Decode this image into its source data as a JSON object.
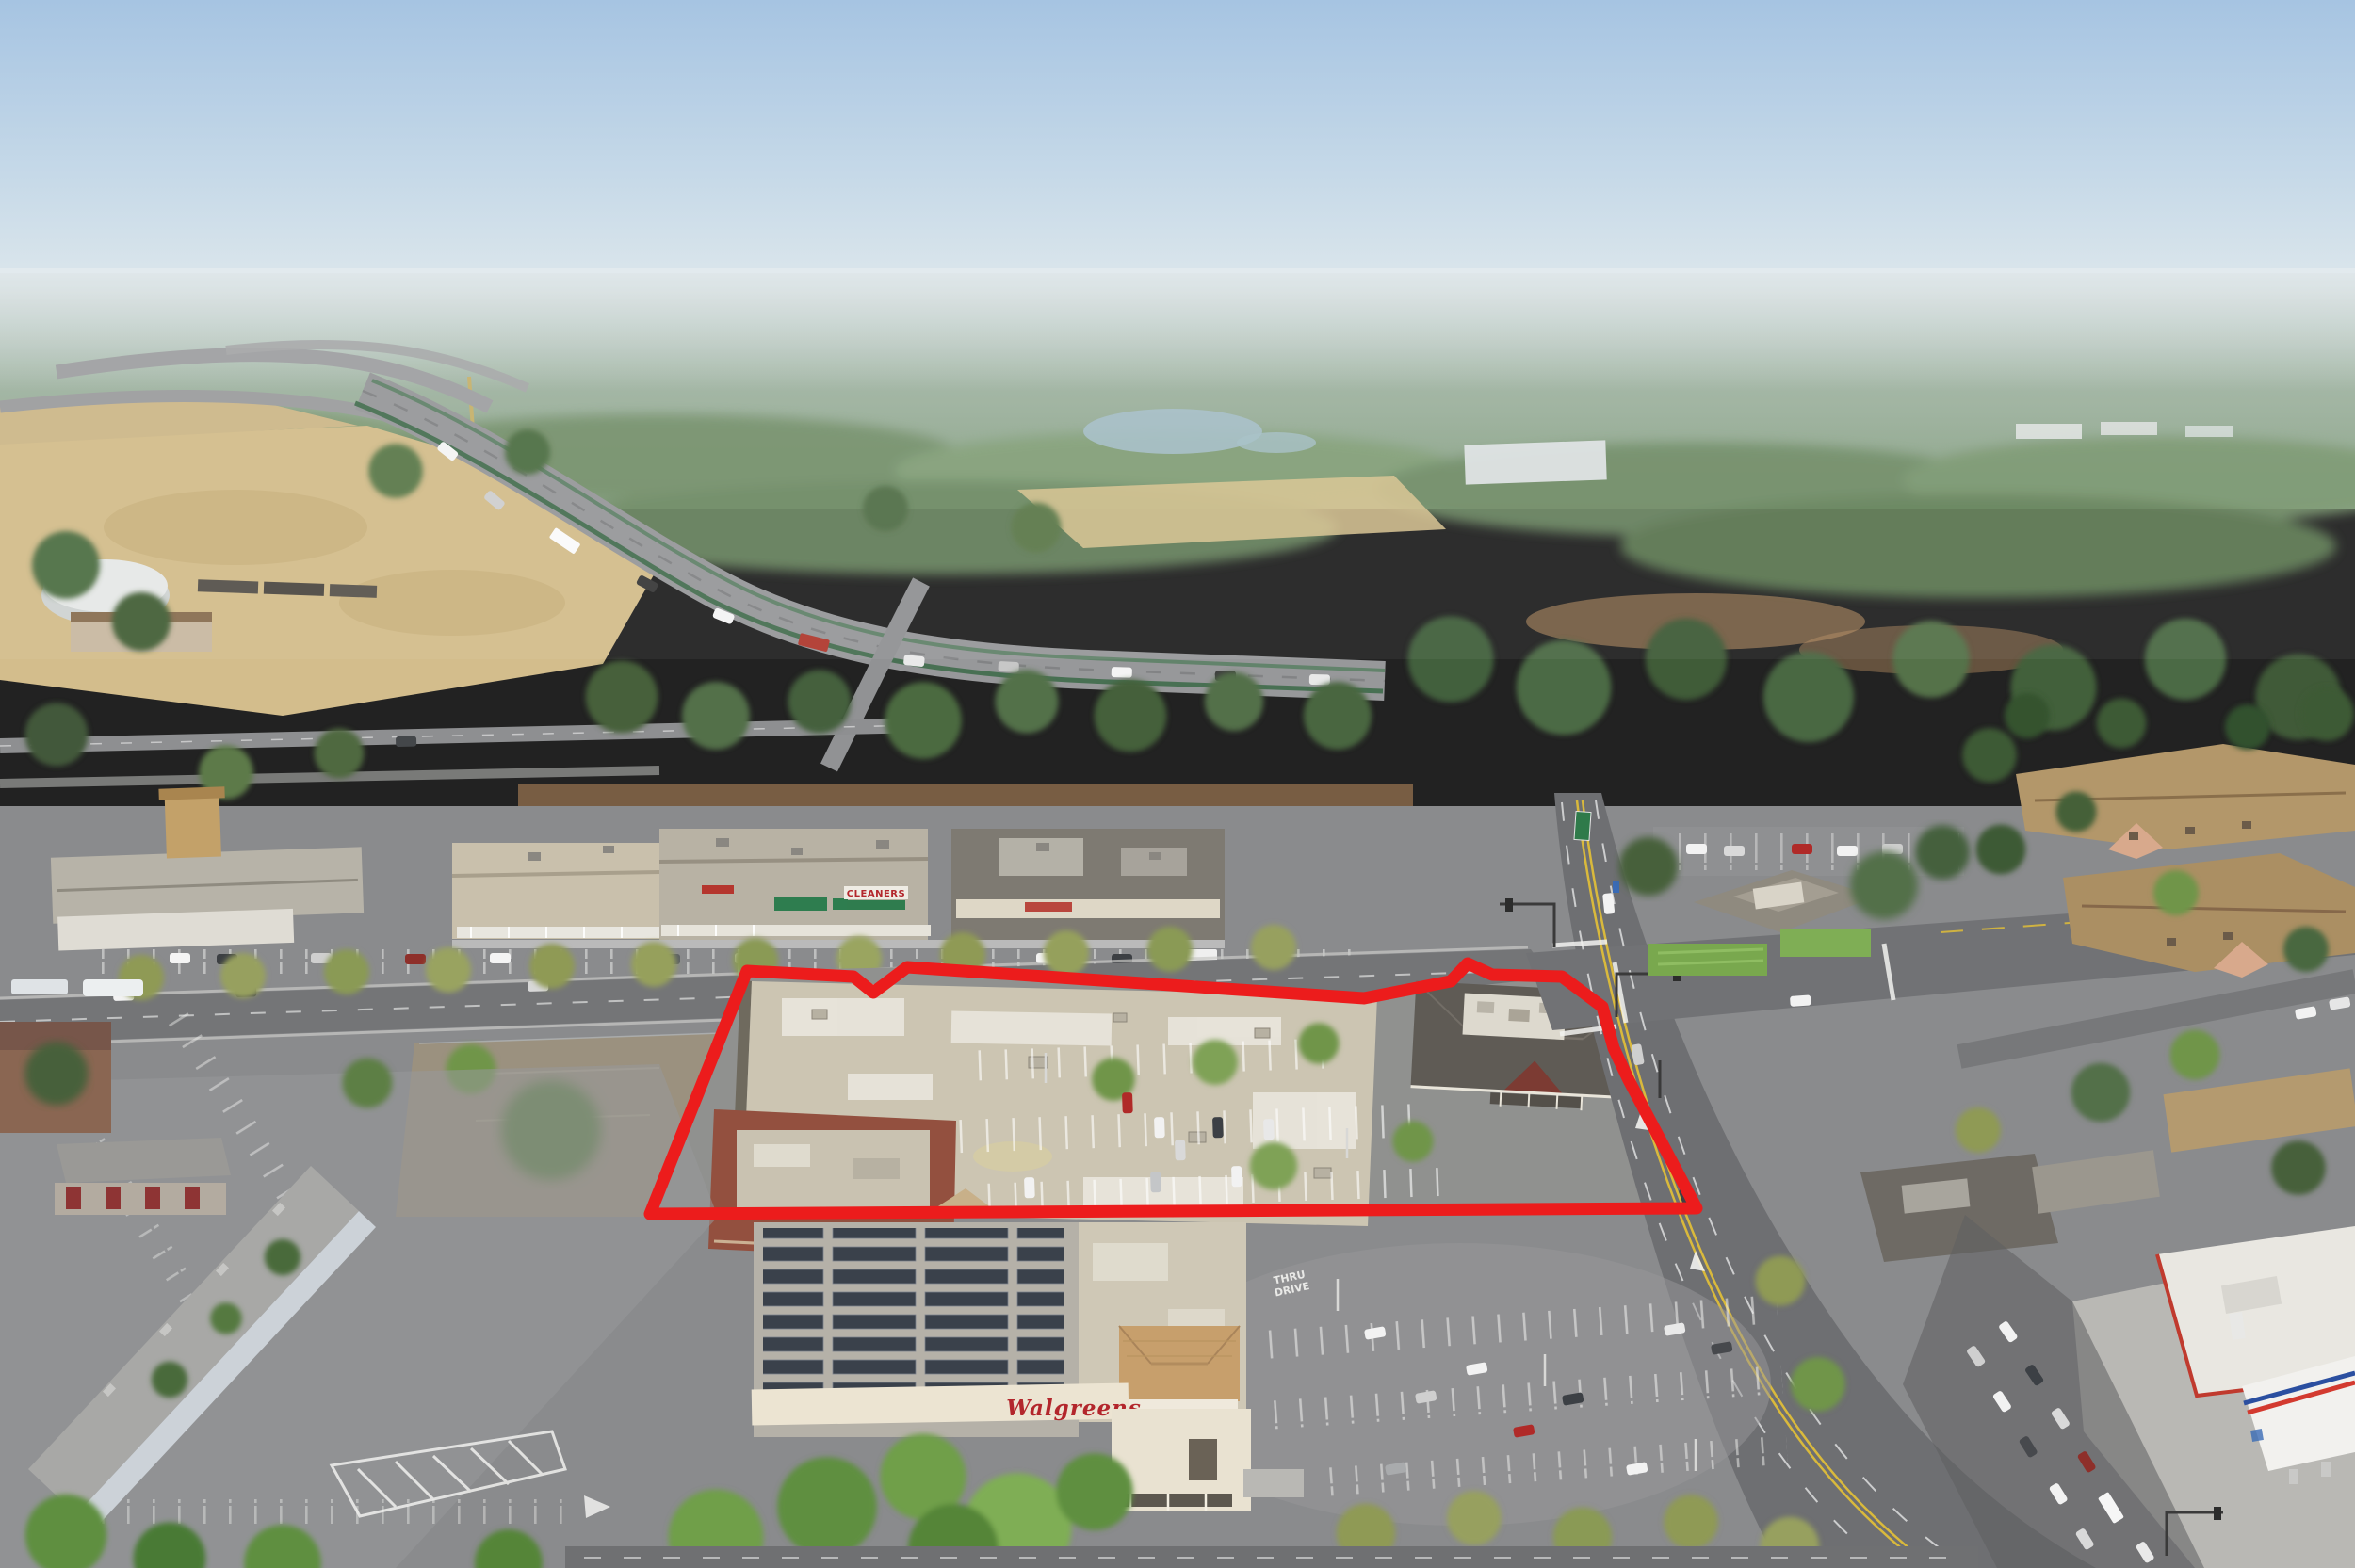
{
  "image": {
    "type": "aerial-drone-photograph",
    "description": "Oblique aerial photo of a suburban commercial corridor on a clear hazy day. A thick red boundary polygon highlights a subject property containing a large flat-roof retail building, a striped parking field with tree planters, and a corner pad building beside a signalized intersection. A Walgreens drugstore with rooftop solar panels sits in the foreground; a strip mall with a CLEANERS storefront sits behind the site; an elevated freeway interchange, dry fields, a water tank, a freight train and tree-covered suburbs fill the background.",
    "time_of_day": "morning, long shadows to upper-left",
    "horizon": "flat, hazy blue-white"
  },
  "annotation": {
    "name": "subject-property-outline",
    "shape": "polygon",
    "color": "#ec1c1c",
    "stroke_width_px": 13,
    "vertices": [
      [
        690,
        1289
      ],
      [
        793,
        1031
      ],
      [
        906,
        1037
      ],
      [
        927,
        1054
      ],
      [
        963,
        1027
      ],
      [
        1448,
        1060
      ],
      [
        1540,
        1042
      ],
      [
        1558,
        1023
      ],
      [
        1584,
        1035
      ],
      [
        1658,
        1037
      ],
      [
        1701,
        1069
      ],
      [
        1713,
        1113
      ],
      [
        1729,
        1147
      ],
      [
        1801,
        1283
      ]
    ],
    "encloses": [
      "flat-roof retail building with maroon storefront",
      "parking field with landscaped planters",
      "hip-roof corner pad building"
    ]
  },
  "signs": {
    "cleaners": "CLEANERS",
    "walgreens": "Walgreens",
    "pavement_line1": "THRU",
    "pavement_line2": "DRIVE"
  },
  "palette": {
    "annotation_red": "#ec1c1c",
    "sign_red": "#b3262c",
    "marking_white": "#e9e9e7",
    "sky_top": "#a6c4e2",
    "sky_horizon": "#dde7ec",
    "distant_trees": "#8aa383",
    "dry_grass": "#d3bd8c",
    "asphalt": "#8a8b8d",
    "asphalt_dark": "#6e6f72",
    "roof_light": "#ccc5b2",
    "roof_dark": "#5f5b55",
    "maroon_wall": "#93503f",
    "tree_dark": "#46603a",
    "tree_olive": "#8f9a55",
    "tree_green": "#6f9549",
    "lane_yellow": "#d9b93c",
    "solar_panel": "#3a414b",
    "tile_roof": "#c79f6c",
    "awning_green": "#2e7d4f",
    "water": "#a7c0cb"
  },
  "scene": {
    "areas": [
      "hazy sky",
      "distant suburban tree canopy",
      "mid-rise buildings with red-orange roof (far left)",
      "white water tank",
      "freight train",
      "elevated freeway interchange with traffic",
      "green-railed freeway viaduct",
      "dry golden field",
      "river glimpse",
      "strip mall with colonnade, green awnings and CLEANERS sign",
      "street with angled parking and street trees",
      "vacant fenced lot",
      "subject retail building (tan roof, maroon front)",
      "subject parking field with planters",
      "corner pad building (dark hip roof, maroon gable)",
      "signalized arterial intersection with green highway sign",
      "office building with lawn",
      "apartment complex with tan roofs among conifers",
      "Walgreens store with rooftop solar array, tile tower and drive-thru",
      "THRU DRIVE pavement marking",
      "long gray warehouse and rear parking lot with hatched striping",
      "gas station with red/blue striped canopy",
      "queued traffic at bottom-right signals"
    ]
  }
}
